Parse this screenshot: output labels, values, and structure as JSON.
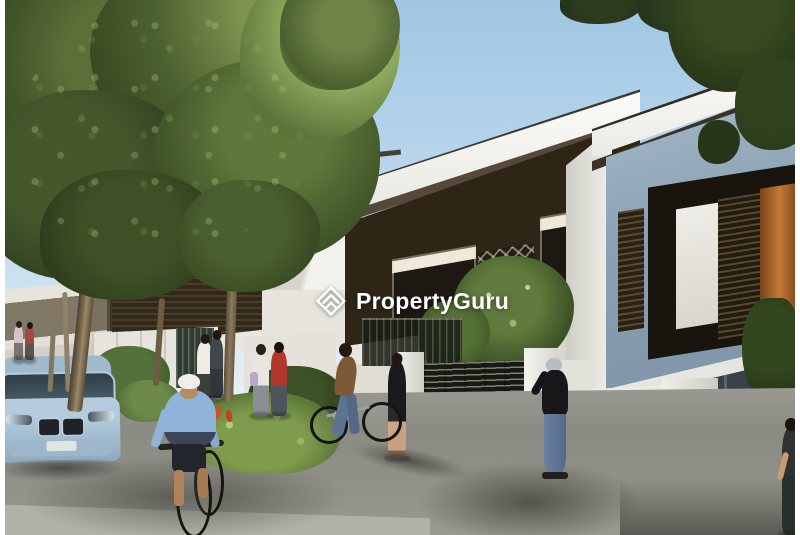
{
  "watermark": {
    "brand": "PropertyGuru",
    "logo_icon": "propertyguru-diamond-chevron-logo"
  },
  "colors": {
    "sky_top": "#9fc6e3",
    "sky_horizon": "#eef2ef",
    "foliage_dark": "#2f4120",
    "foliage_mid": "#55703a",
    "foliage_light": "#9db36a",
    "roof_white": "#f4f4f0",
    "louver_dark": "#2e2517",
    "wall_white": "#e8e6df",
    "wall_blue_gray": "#8ba1b3",
    "window_glow": "#c27a35",
    "gate_metal": "#44423a",
    "road": "#8e8d86",
    "sidewalk": "#b2b1a7",
    "car_body": "#a9c4d8",
    "watermark": "#ffffff"
  },
  "scene": {
    "type": "architectural-rendering",
    "subject": "Modern two-storey terrace houses along a landscaped street with a large tree, pedestrians, two cyclists and a parked light-blue SUV"
  }
}
